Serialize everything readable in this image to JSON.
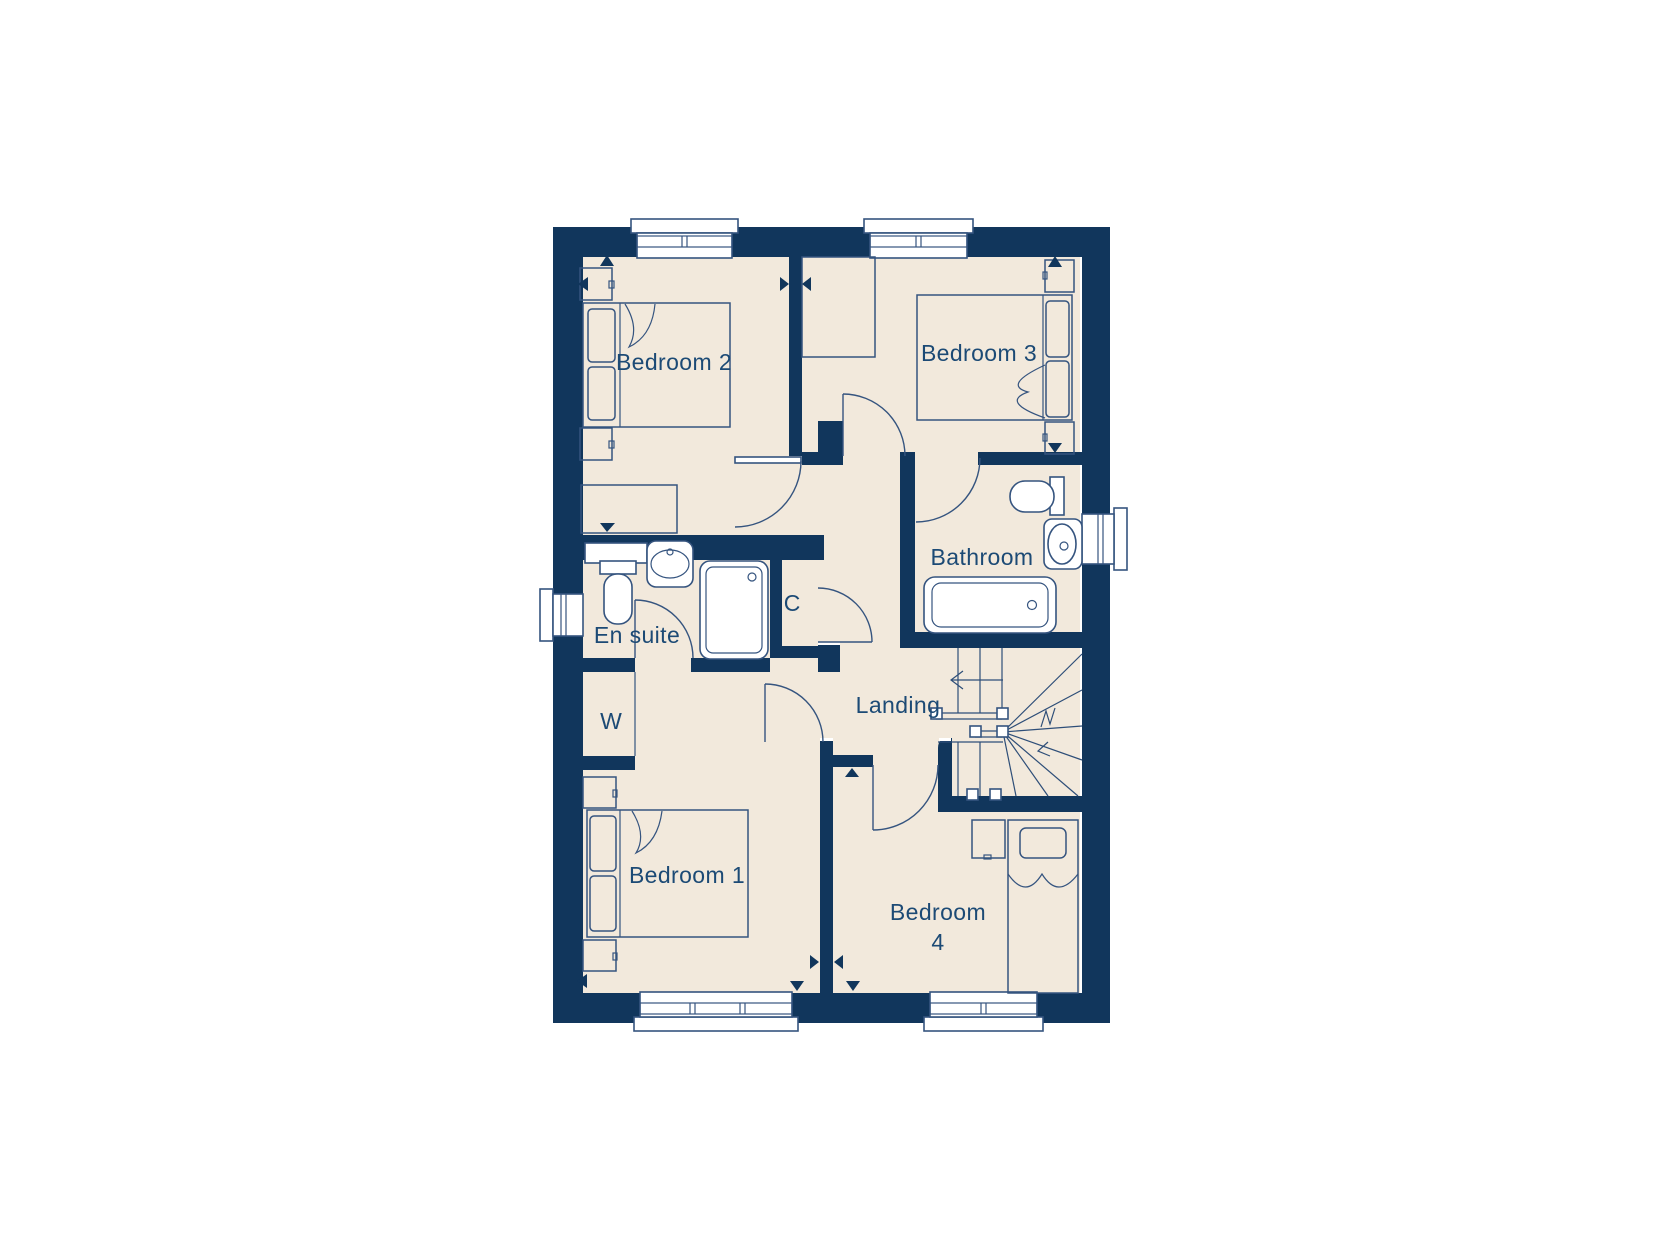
{
  "figure": {
    "type": "floor-plan",
    "palette": {
      "background": "#ffffff",
      "wall": "#11365c",
      "floor": "#f2e9dc",
      "furniture_line": "#35547f",
      "label_text": "#1c4a75",
      "fixture_fill": "#ffffff"
    },
    "rooms": {
      "bedroom2": {
        "label": "Bedroom 2"
      },
      "bedroom3": {
        "label": "Bedroom 3"
      },
      "bathroom": {
        "label": "Bathroom"
      },
      "ensuite": {
        "label": "En suite"
      },
      "cupboard": {
        "label": "C"
      },
      "wardrobe": {
        "label": "W"
      },
      "landing": {
        "label": "Landing"
      },
      "bedroom1": {
        "label": "Bedroom 1"
      },
      "bedroom4": {
        "label": "Bedroom 4",
        "line1": "Bedroom",
        "line2": "4"
      }
    },
    "fixtures": [
      "double-bed-icon",
      "pillow-icon",
      "bedside-cabinet-icon",
      "chest-of-drawers-icon",
      "wardrobe-icon",
      "toilet-icon",
      "wash-basin-icon",
      "shower-tray-icon",
      "bathtub-icon",
      "staircase-icon",
      "window-icon",
      "door-swing-icon",
      "stair-direction-arrow-icon",
      "opening-marker-icon"
    ]
  }
}
